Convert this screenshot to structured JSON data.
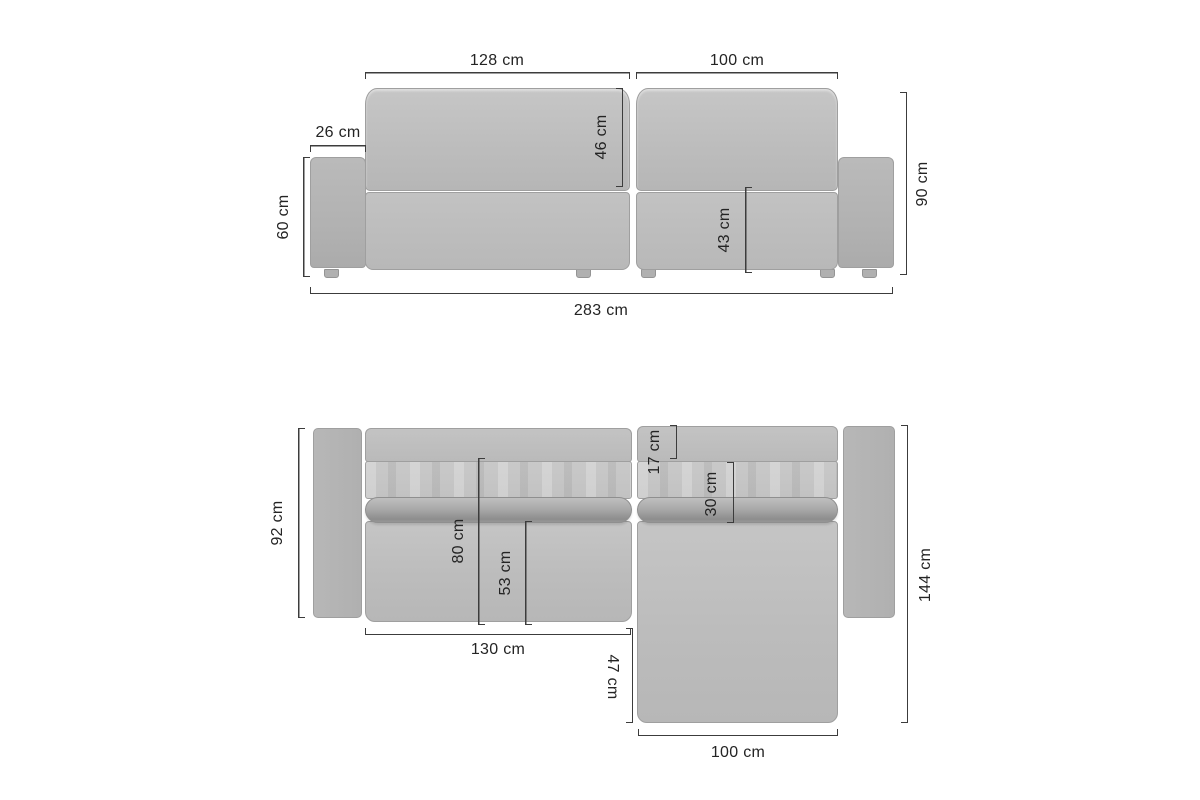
{
  "diagram_title": "corner-sofa-dimensions",
  "unit": "cm",
  "colors": {
    "canvas-bg": "#ffffff",
    "dim-line": "#3c3c3c",
    "dim-text": "#242424",
    "outline": "#9f9f9f"
  },
  "front_view": {
    "labels": {
      "backrest_left_width": "128 cm",
      "backrest_right_width": "100 cm",
      "armrest_width": "26 cm",
      "backrest_cushion_height": "46 cm",
      "armrest_height": "60 cm",
      "seat_height": "43 cm",
      "overall_height": "90 cm",
      "overall_width": "283 cm"
    }
  },
  "top_view": {
    "labels": {
      "armrest_depth": "92 cm",
      "back_top_depth": "17 cm",
      "backrest_depth": "30 cm",
      "seat_area_depth": "80 cm",
      "seat_cushion_depth": "53 cm",
      "overall_depth": "144 cm",
      "seat_width": "130 cm",
      "chaise_extension_depth": "47 cm",
      "chaise_width": "100 cm"
    }
  }
}
